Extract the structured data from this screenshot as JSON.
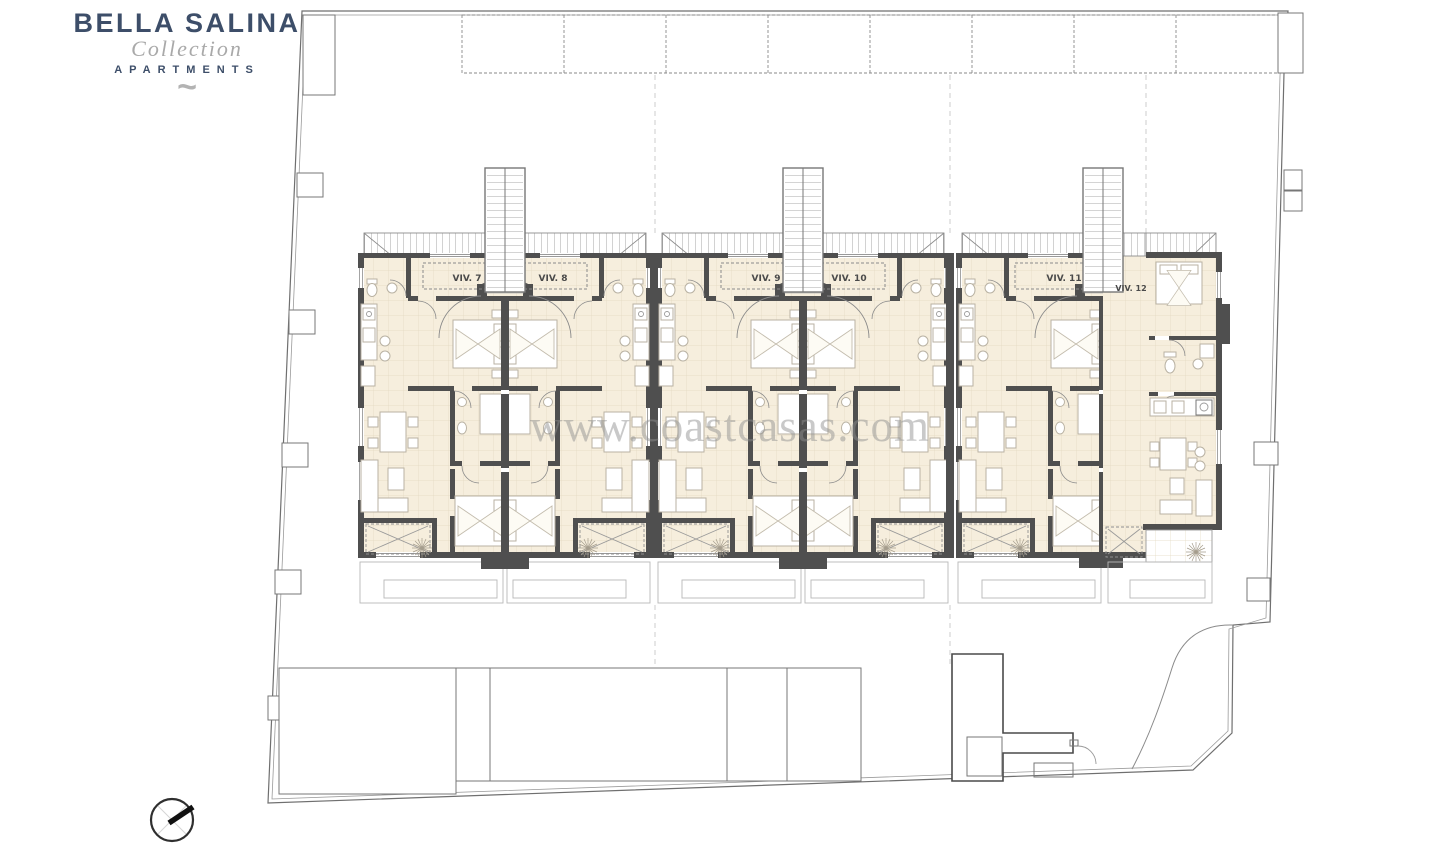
{
  "logo": {
    "title": "BELLA SALINA",
    "subtitle": "Collection",
    "tagline": "APARTMENTS",
    "mark": "~",
    "title_color": "#3d4e69",
    "subtitle_color": "#a9a9a9"
  },
  "watermark": {
    "text": "www.coastcasas.com",
    "color": "#8f8f8f"
  },
  "plan": {
    "type": "apartment-floor-plan",
    "units": [
      {
        "id": "viv-7",
        "label": "VIV. 7"
      },
      {
        "id": "viv-8",
        "label": "VIV. 8"
      },
      {
        "id": "viv-9",
        "label": "VIV. 9"
      },
      {
        "id": "viv-10",
        "label": "VIV. 10"
      },
      {
        "id": "viv-11",
        "label": "VIV. 11"
      },
      {
        "id": "viv-12",
        "label": "VIV. 12"
      }
    ],
    "colors": {
      "wall": "#4f4f4f",
      "floor": "#f6eedd",
      "tile_line": "#e3d8c0",
      "outline": "#6f6f6f",
      "stairs": "#8d8d8d",
      "terrace_dash": "#8f8f8f"
    },
    "compass": {
      "icon": "north-arrow",
      "direction": "north-east"
    }
  }
}
